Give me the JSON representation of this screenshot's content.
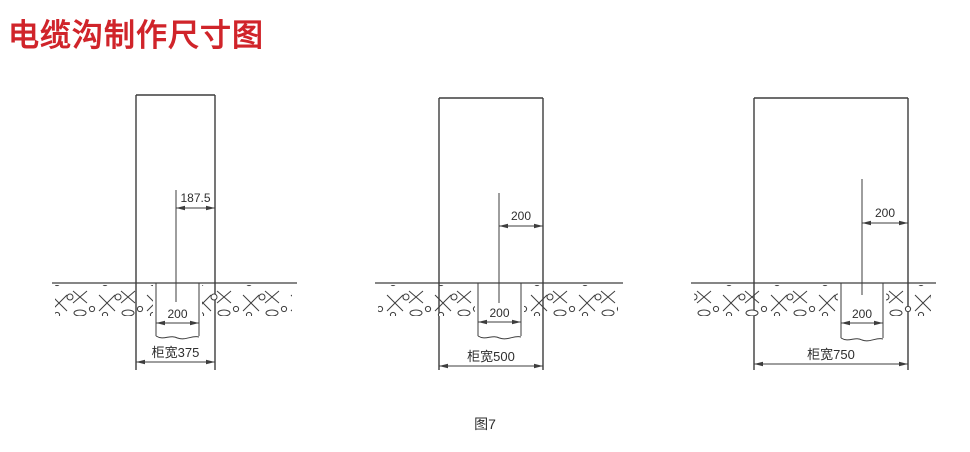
{
  "header": {
    "title": "电缆沟制作尺寸图"
  },
  "caption": "图7",
  "colors": {
    "title": "#d0242a",
    "line": "#3d3d3d",
    "text": "#2e2e2e"
  },
  "diagram_data": {
    "type": "technical-drawing",
    "title": "电缆沟制作尺寸图",
    "figure_caption": "图7",
    "figures": [
      {
        "id": "cabinet-width-375",
        "labels": {
          "top_offset": "187.5",
          "trench_width": "200",
          "cabinet_width": "柜宽375"
        },
        "geom": {
          "cab_left": 136,
          "cab_right": 215,
          "cab_top": 95,
          "edge_bottom": 370,
          "ground_y": 283,
          "ground_x1": 52,
          "ground_x2": 297,
          "trench_left": 156,
          "trench_right": 199,
          "trench_bottom": 338,
          "center_x": 176,
          "center_top": 190,
          "center_bottom": 302,
          "top_dim_y": 208,
          "trench_dim_y": 323,
          "bottom_dim_y": 362
        }
      },
      {
        "id": "cabinet-width-500",
        "labels": {
          "top_offset": "200",
          "trench_width": "200",
          "cabinet_width": "柜宽500"
        },
        "geom": {
          "cab_left": 439,
          "cab_right": 543,
          "cab_top": 98,
          "edge_bottom": 370,
          "ground_y": 283,
          "ground_x1": 375,
          "ground_x2": 623,
          "trench_left": 478,
          "trench_right": 521,
          "trench_bottom": 338,
          "center_x": 499,
          "center_top": 193,
          "center_bottom": 303,
          "top_dim_y": 226,
          "trench_dim_y": 322,
          "bottom_dim_y": 366
        }
      },
      {
        "id": "cabinet-width-750",
        "labels": {
          "top_offset": "200",
          "trench_width": "200",
          "cabinet_width": "柜宽750"
        },
        "geom": {
          "cab_left": 754,
          "cab_right": 908,
          "cab_top": 98,
          "edge_bottom": 370,
          "ground_y": 283,
          "ground_x1": 691,
          "ground_x2": 936,
          "trench_left": 841,
          "trench_right": 883,
          "trench_bottom": 340,
          "center_x": 862,
          "center_top": 179,
          "center_bottom": 295,
          "top_dim_y": 223,
          "trench_dim_y": 323,
          "bottom_dim_y": 364
        }
      }
    ]
  }
}
